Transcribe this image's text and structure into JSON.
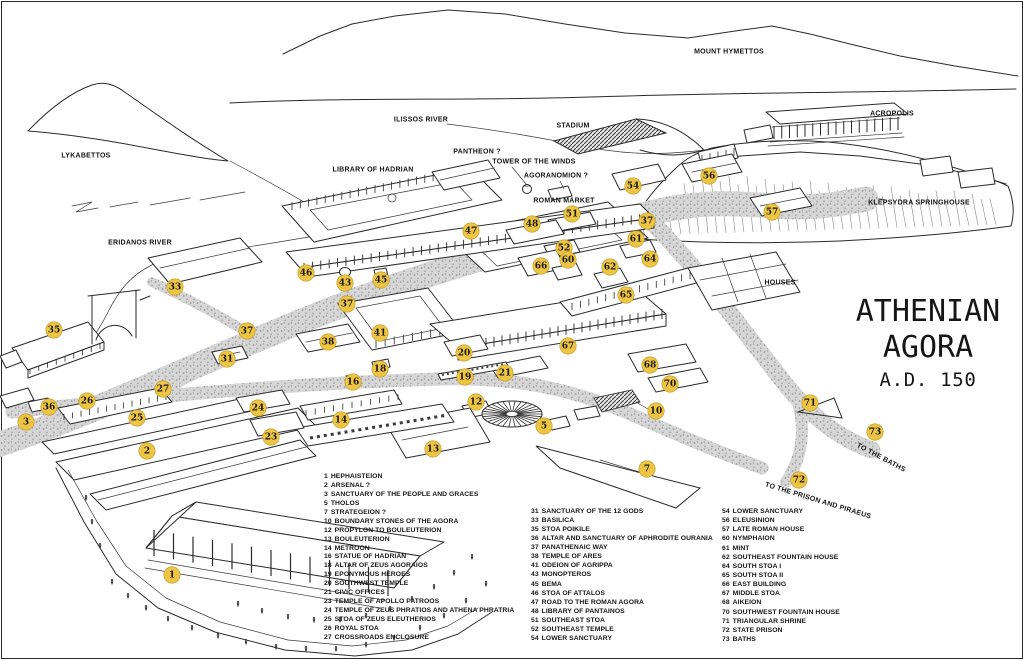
{
  "title": {
    "line1": "ATHENIAN",
    "line2": "AGORA",
    "line3": "A.D. 150"
  },
  "colors": {
    "marker_fill": "#EEC542",
    "ink": "#2b2b2b",
    "road_fill": "#d6d6d6",
    "road_dot": "#9b9b9b"
  },
  "map_labels": [
    {
      "id": "mount-hymettos",
      "text": "MOUNT HYMETTOS",
      "x": 729,
      "y": 52,
      "rotate": 0
    },
    {
      "id": "lykabettos",
      "text": "LYKABETTOS",
      "x": 86,
      "y": 156,
      "rotate": 0
    },
    {
      "id": "ilissos-river",
      "text": "ILISSOS RIVER",
      "x": 421,
      "y": 120,
      "rotate": 0
    },
    {
      "id": "stadium",
      "text": "STADIUM",
      "x": 573,
      "y": 126,
      "rotate": 0
    },
    {
      "id": "pantheon",
      "text": "PANTHEON ?",
      "x": 477,
      "y": 152,
      "rotate": 0
    },
    {
      "id": "tower-of-the-winds",
      "text": "TOWER OF THE WINDS",
      "x": 534,
      "y": 162,
      "rotate": 0
    },
    {
      "id": "agoranomion",
      "text": "AGORANOMION ?",
      "x": 556,
      "y": 176,
      "rotate": 0
    },
    {
      "id": "roman-market",
      "text": "ROMAN MARKET",
      "x": 564,
      "y": 201,
      "rotate": 0
    },
    {
      "id": "library-of-hadrian",
      "text": "LIBRARY OF HADRIAN",
      "x": 373,
      "y": 170,
      "rotate": 0
    },
    {
      "id": "acropolis",
      "text": "ACROPOLIS",
      "x": 892,
      "y": 114,
      "rotate": 0
    },
    {
      "id": "klepsydra-springhouse",
      "text": "KLEPSYDRA SPRINGHOUSE",
      "x": 919,
      "y": 203,
      "rotate": 0
    },
    {
      "id": "eridanos-river",
      "text": "ERIDANOS RIVER",
      "x": 140,
      "y": 243,
      "rotate": 0
    },
    {
      "id": "houses",
      "text": "HOUSES",
      "x": 780,
      "y": 283,
      "rotate": 0
    },
    {
      "id": "to-the-baths",
      "text": "TO THE BATHS",
      "x": 881,
      "y": 458,
      "rotate": 28
    },
    {
      "id": "to-the-prison-and-piraeus",
      "text": "TO THE PRISON AND PIRAEUS",
      "x": 818,
      "y": 501,
      "rotate": 17
    }
  ],
  "markers": [
    {
      "n": "1",
      "x": 172,
      "y": 575
    },
    {
      "n": "2",
      "x": 147,
      "y": 451
    },
    {
      "n": "3",
      "x": 26,
      "y": 422
    },
    {
      "n": "5",
      "x": 544,
      "y": 426
    },
    {
      "n": "7",
      "x": 647,
      "y": 469
    },
    {
      "n": "10",
      "x": 656,
      "y": 411
    },
    {
      "n": "12",
      "x": 476,
      "y": 402
    },
    {
      "n": "13",
      "x": 433,
      "y": 449
    },
    {
      "n": "14",
      "x": 341,
      "y": 420
    },
    {
      "n": "16",
      "x": 353,
      "y": 382
    },
    {
      "n": "18",
      "x": 380,
      "y": 369
    },
    {
      "n": "19",
      "x": 465,
      "y": 377
    },
    {
      "n": "20",
      "x": 464,
      "y": 353
    },
    {
      "n": "21",
      "x": 505,
      "y": 373
    },
    {
      "n": "23",
      "x": 271,
      "y": 437
    },
    {
      "n": "24",
      "x": 258,
      "y": 408
    },
    {
      "n": "25",
      "x": 137,
      "y": 418
    },
    {
      "n": "26",
      "x": 87,
      "y": 401
    },
    {
      "n": "27",
      "x": 163,
      "y": 389
    },
    {
      "n": "31",
      "x": 227,
      "y": 359
    },
    {
      "n": "33",
      "x": 175,
      "y": 287
    },
    {
      "n": "35",
      "x": 54,
      "y": 330
    },
    {
      "n": "36",
      "x": 49,
      "y": 407
    },
    {
      "n": "37",
      "x": 247,
      "y": 331
    },
    {
      "n": "37",
      "x": 347,
      "y": 304
    },
    {
      "n": "37",
      "x": 647,
      "y": 221
    },
    {
      "n": "38",
      "x": 328,
      "y": 342
    },
    {
      "n": "41",
      "x": 380,
      "y": 333
    },
    {
      "n": "43",
      "x": 345,
      "y": 283
    },
    {
      "n": "45",
      "x": 381,
      "y": 280
    },
    {
      "n": "46",
      "x": 306,
      "y": 273
    },
    {
      "n": "47",
      "x": 471,
      "y": 231
    },
    {
      "n": "48",
      "x": 532,
      "y": 224
    },
    {
      "n": "51",
      "x": 572,
      "y": 214
    },
    {
      "n": "52",
      "x": 564,
      "y": 248
    },
    {
      "n": "54",
      "x": 633,
      "y": 186
    },
    {
      "n": "56",
      "x": 709,
      "y": 176
    },
    {
      "n": "57",
      "x": 772,
      "y": 212
    },
    {
      "n": "60",
      "x": 568,
      "y": 260
    },
    {
      "n": "61",
      "x": 636,
      "y": 239
    },
    {
      "n": "62",
      "x": 610,
      "y": 267
    },
    {
      "n": "64",
      "x": 650,
      "y": 259
    },
    {
      "n": "65",
      "x": 626,
      "y": 295
    },
    {
      "n": "66",
      "x": 541,
      "y": 266
    },
    {
      "n": "67",
      "x": 568,
      "y": 346
    },
    {
      "n": "68",
      "x": 650,
      "y": 365
    },
    {
      "n": "70",
      "x": 670,
      "y": 384
    },
    {
      "n": "71",
      "x": 810,
      "y": 403
    },
    {
      "n": "72",
      "x": 799,
      "y": 480
    },
    {
      "n": "73",
      "x": 875,
      "y": 432
    }
  ],
  "legend": {
    "columns": [
      {
        "items": [
          {
            "n": "1",
            "label": "HEPHAISTEION"
          },
          {
            "n": "2",
            "label": "ARSENAL ?"
          },
          {
            "n": "3",
            "label": "SANCTUARY OF THE PEOPLE AND GRACES"
          },
          {
            "n": "5",
            "label": "THOLOS"
          },
          {
            "n": "7",
            "label": "STRATEGEION ?"
          },
          {
            "n": "10",
            "label": "BOUNDARY STONES OF THE AGORA"
          },
          {
            "n": "12",
            "label": "PROPYLON TO BOULEUTERION"
          },
          {
            "n": "13",
            "label": "BOULEUTERION"
          },
          {
            "n": "14",
            "label": "METROON"
          },
          {
            "n": "16",
            "label": "STATUE OF HADRIAN"
          },
          {
            "n": "18",
            "label": "ALTAR OF ZEUS AGORAIOS"
          },
          {
            "n": "19",
            "label": "EPONYMOUS HEROES"
          },
          {
            "n": "20",
            "label": "SOUTHWEST TEMPLE"
          },
          {
            "n": "21",
            "label": "CIVIC OFFICES"
          },
          {
            "n": "23",
            "label": "TEMPLE OF APOLLO PATROOS"
          },
          {
            "n": "24",
            "label": "TEMPLE OF ZEUS PHRATIOS AND ATHENA PHRATRIA"
          },
          {
            "n": "25",
            "label": "STOA OF ZEUS ELEUTHERIOS"
          },
          {
            "n": "26",
            "label": "ROYAL STOA"
          },
          {
            "n": "27",
            "label": "CROSSROADS ENCLOSURE"
          }
        ]
      },
      {
        "items": [
          {
            "n": "31",
            "label": "SANCTUARY OF THE 12 GODS"
          },
          {
            "n": "33",
            "label": "BASILICA"
          },
          {
            "n": "35",
            "label": "STOA POIKILE"
          },
          {
            "n": "36",
            "label": "ALTAR AND SANCTUARY OF APHRODITE OURANIA"
          },
          {
            "n": "37",
            "label": "PANATHENAIC WAY"
          },
          {
            "n": "38",
            "label": "TEMPLE OF ARES"
          },
          {
            "n": "41",
            "label": "ODEION OF AGRIPPA"
          },
          {
            "n": "43",
            "label": "MONOPTEROS"
          },
          {
            "n": "45",
            "label": "BEMA"
          },
          {
            "n": "46",
            "label": "STOA OF ATTALOS"
          },
          {
            "n": "47",
            "label": "ROAD TO THE ROMAN AGORA"
          },
          {
            "n": "48",
            "label": "LIBRARY OF PANTAINOS"
          },
          {
            "n": "51",
            "label": "SOUTHEAST STOA"
          },
          {
            "n": "52",
            "label": "SOUTHEAST TEMPLE"
          },
          {
            "n": "54",
            "label": "LOWER SANCTUARY"
          }
        ]
      },
      {
        "items": [
          {
            "n": "54",
            "label": "LOWER SANCTUARY"
          },
          {
            "n": "56",
            "label": "ELEUSINION"
          },
          {
            "n": "57",
            "label": "LATE ROMAN HOUSE"
          },
          {
            "n": "60",
            "label": "NYMPHAION"
          },
          {
            "n": "61",
            "label": "MINT"
          },
          {
            "n": "62",
            "label": "SOUTHEAST FOUNTAIN HOUSE"
          },
          {
            "n": "64",
            "label": "SOUTH STOA I"
          },
          {
            "n": "65",
            "label": "SOUTH STOA II"
          },
          {
            "n": "66",
            "label": "EAST BUILDING"
          },
          {
            "n": "67",
            "label": "MIDDLE STOA"
          },
          {
            "n": "68",
            "label": "AIKEION"
          },
          {
            "n": "70",
            "label": "SOUTHWEST FOUNTAIN HOUSE"
          },
          {
            "n": "71",
            "label": "TRIANGULAR SHRINE"
          },
          {
            "n": "72",
            "label": "STATE PRISON"
          },
          {
            "n": "73",
            "label": "BATHS"
          }
        ]
      }
    ]
  }
}
